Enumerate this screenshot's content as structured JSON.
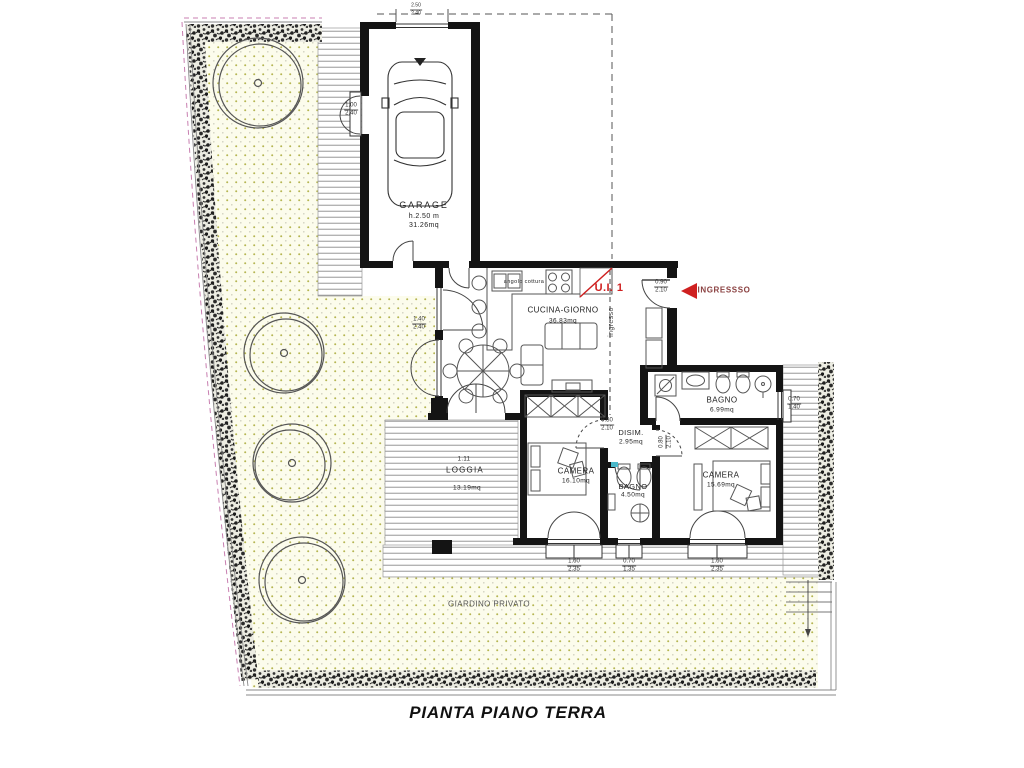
{
  "title": "PIANTA PIANO TERRA",
  "unit": {
    "label": "U.I. 1"
  },
  "entrance": {
    "label": "INGRESSSO",
    "corridor_label": "ingresso"
  },
  "rooms": {
    "garage": {
      "name": "GARAGE",
      "height": "h.2.50 m",
      "area": "31.26mq"
    },
    "cucina": {
      "name": "CUCINA-GIORNO",
      "area": "36.83mq",
      "note": "angolo cottura"
    },
    "bagno1": {
      "name": "BAGNO",
      "area": "6.99mq"
    },
    "disimpegno": {
      "name": "DISIM.",
      "area": "2.95mq"
    },
    "camera1": {
      "name": "CAMERA",
      "area": "16.10mq"
    },
    "bagno2": {
      "name": "BAGNO",
      "area": "4.50mq"
    },
    "camera2": {
      "name": "CAMERA",
      "area": "15.69mq"
    },
    "loggia": {
      "name": "LOGGIA",
      "area": "13.19mq",
      "note": "1.11"
    },
    "giardino": {
      "name": "GIARDINO PRIVATO"
    }
  },
  "dims": {
    "garage_door": {
      "w": "2.50",
      "h": "2.40"
    },
    "garage_side_door": {
      "w": "1.00",
      "h": "2.40"
    },
    "cucina_window": {
      "w": "1.40",
      "h": "2.40"
    },
    "entrance_door": {
      "w": "0.90",
      "h": "2.10"
    },
    "disim_door": {
      "w": "0.80",
      "h": "2.10"
    },
    "bagno2_door": {
      "w": "0.80",
      "h": "2.10"
    },
    "bagno1_window": {
      "w": "0.70",
      "h": "1.40"
    },
    "camera1_window": {
      "w": "1.60",
      "h": "2.35"
    },
    "bagno2_window": {
      "w": "0.70",
      "h": "1.35"
    },
    "camera2_window": {
      "w": "1.60",
      "h": "2.35"
    }
  },
  "colors": {
    "accent_red": "#cf2020",
    "entrance_text": "#8a4040",
    "wall": "#141414",
    "garden_fill": "#fcfcec",
    "garden_dot": "#b5b552",
    "hatch_line": "#8a8a8a",
    "boundary_pink": "#c87fb0"
  }
}
